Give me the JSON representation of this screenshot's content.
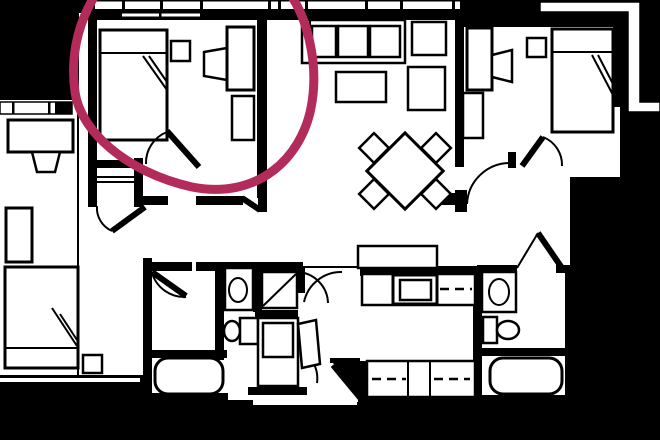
{
  "meta": {
    "kind": "floor-plan-screenshot",
    "description": "Black and white apartment floor plan on a black background with a hand-drawn crimson circle highlighting the top-left bedroom"
  },
  "palette": {
    "background": "#000000",
    "floor": "#ffffff",
    "lines": "#000000",
    "annotation": "#b22b5b"
  },
  "annotation": {
    "kind": "hand-drawn-circle",
    "target": "bedroom-top-left",
    "color": "#b22b5b",
    "stroke_width": 9
  },
  "rooms": [
    {
      "id": "bedroom-1",
      "label": "Bedroom (top left, circled)",
      "furniture": [
        "double bed",
        "nightstand",
        "wardrobe",
        "closet"
      ]
    },
    {
      "id": "living-room",
      "label": "Living room",
      "furniture": [
        "sofa",
        "coffee table",
        "armchair",
        "side table"
      ]
    },
    {
      "id": "dining-area",
      "label": "Dining area",
      "furniture": [
        "square table rotated 45 degrees",
        "4 chairs"
      ]
    },
    {
      "id": "bedroom-2",
      "label": "Bedroom (top right)",
      "furniture": [
        "double bed",
        "nightstand",
        "wardrobe"
      ]
    },
    {
      "id": "bathroom-1",
      "label": "Bathroom (center)",
      "furniture": [
        "vanity sink",
        "toilet",
        "shower",
        "bathtub",
        "linen closet"
      ]
    },
    {
      "id": "kitchen",
      "label": "Kitchen",
      "furniture": [
        "counter",
        "stove",
        "island with cabinet fronts"
      ]
    },
    {
      "id": "bathroom-2",
      "label": "Bathroom (right)",
      "furniture": [
        "vanity sink",
        "toilet",
        "bathtub"
      ]
    },
    {
      "id": "hallway",
      "label": "Hallway with doors"
    },
    {
      "id": "entry",
      "label": "Entry vestibule (bottom)"
    },
    {
      "id": "neighbor-room",
      "label": "Adjacent unit room (left edge)",
      "furniture": [
        "desk",
        "chair",
        "dresser",
        "bed",
        "nightstand"
      ]
    },
    {
      "id": "balcony",
      "label": "Balcony railing (top edge)"
    }
  ]
}
